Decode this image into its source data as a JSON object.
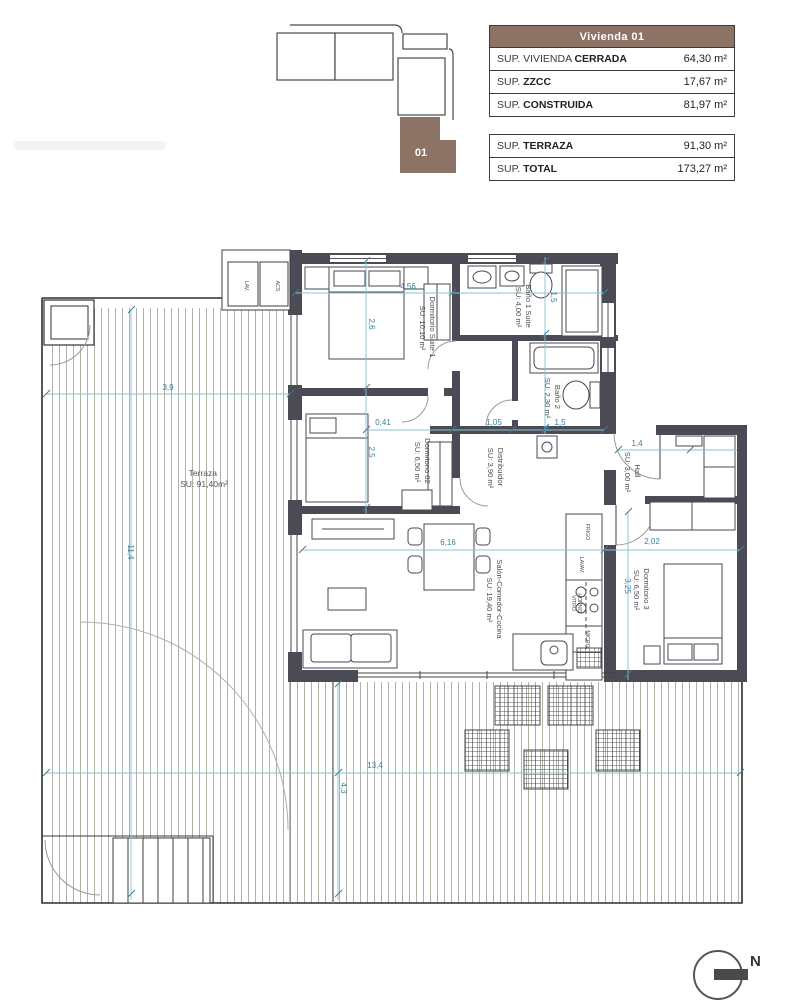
{
  "header": {
    "keyplan_unit": "01",
    "table1": {
      "title": "Vivienda 01",
      "rows": [
        {
          "pre": "SUP. VIVIENDA ",
          "bold": "CERRADA",
          "value": "64,30 m²"
        },
        {
          "pre": "SUP. ",
          "bold": "ZZCC",
          "value": "17,67 m²"
        },
        {
          "pre": "SUP. ",
          "bold": "CONSTRUIDA",
          "value": "81,97 m²"
        }
      ]
    },
    "table2": {
      "rows": [
        {
          "pre": "SUP. ",
          "bold": "TERRAZA",
          "value": "91,30 m²"
        },
        {
          "pre": "SUP. ",
          "bold": "TOTAL",
          "value": "173,27 m²"
        }
      ]
    }
  },
  "plan": {
    "rooms": [
      {
        "name": "Dormitorio Suite 1",
        "area": "SU: 10,10 m²"
      },
      {
        "name": "Baño 1 Suite",
        "area": "SU: 4,00 m²"
      },
      {
        "name": "Baño 2",
        "area": "SU: 2,30 m²"
      },
      {
        "name": "Dormitorio 02",
        "area": "SU: 6,50 m²"
      },
      {
        "name": "Distribuidor",
        "area": "SU: 3,90 m²"
      },
      {
        "name": "Hall",
        "area": "SU: 3,00 m²"
      },
      {
        "name": "Dormitorio 3",
        "area": "SU: 6,50 m²"
      },
      {
        "name": "Salón-Comedor-Cocina",
        "area": "SU: 19,40 m²"
      },
      {
        "name": "Terraza",
        "area": "SU: 91,40m²"
      }
    ],
    "kitchen_labels": [
      "FRIGO",
      "LAVAV.",
      "VITRO",
      "HORNO",
      "MICRO"
    ],
    "utility_labels": [
      "LAV.",
      "ACS"
    ],
    "dims": [
      {
        "text": "4,56"
      },
      {
        "text": "3,9"
      },
      {
        "text": "0,41"
      },
      {
        "text": "1,05"
      },
      {
        "text": "1,5"
      },
      {
        "text": "1,4"
      },
      {
        "text": "6,16"
      },
      {
        "text": "2,02"
      },
      {
        "text": "13,4"
      },
      {
        "text": "2,6"
      },
      {
        "text": "2,5"
      },
      {
        "text": "1,5"
      },
      {
        "text": "11,4"
      },
      {
        "text": "3,25"
      },
      {
        "text": "4,3"
      }
    ],
    "north": "N"
  },
  "colors": {
    "wall": "#4b4b55",
    "accent_brown": "#8c7365",
    "dimension_teal": "#35809a"
  }
}
